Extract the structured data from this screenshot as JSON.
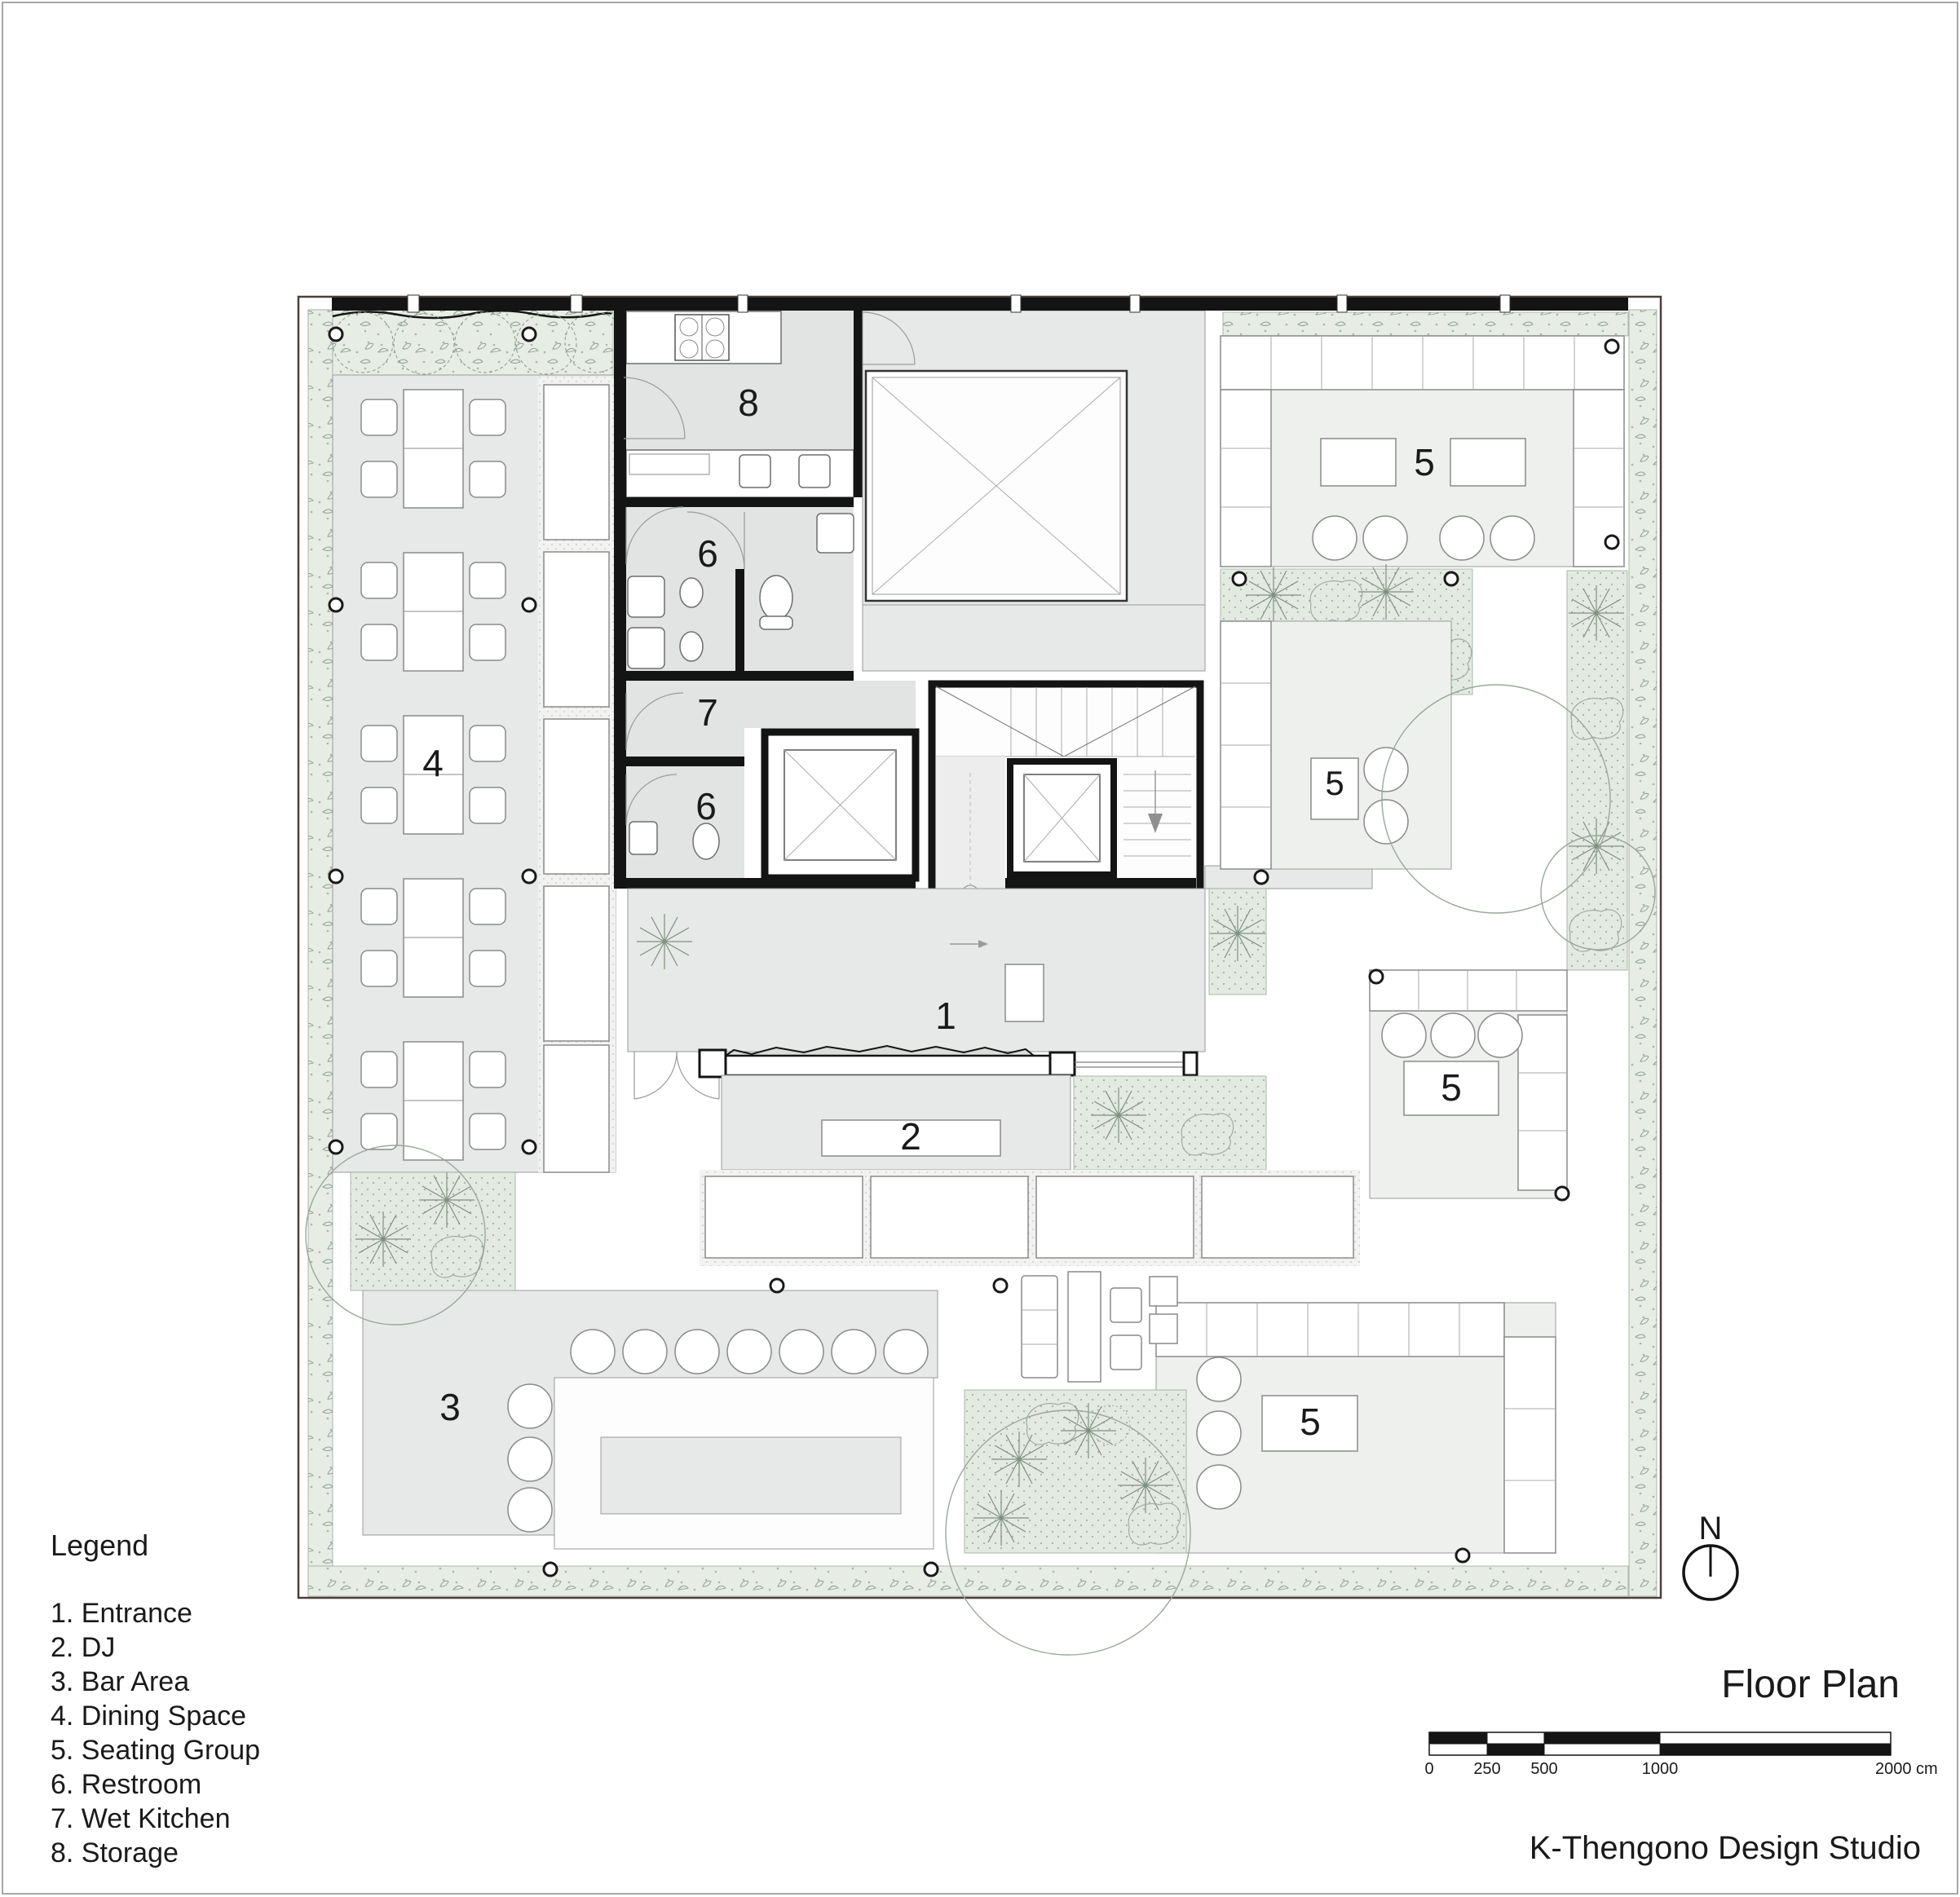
{
  "title_block": {
    "title": "Floor Plan",
    "studio": "K-Thengono Design Studio"
  },
  "north": {
    "label": "N"
  },
  "legend": {
    "title": "Legend",
    "items": [
      {
        "text": "1. Entrance"
      },
      {
        "text": "2. DJ"
      },
      {
        "text": "3. Bar Area"
      },
      {
        "text": "4. Dining Space"
      },
      {
        "text": "5. Seating Group"
      },
      {
        "text": "6. Restroom"
      },
      {
        "text": "7. Wet Kitchen"
      },
      {
        "text": "8. Storage"
      }
    ]
  },
  "plan": {
    "room_labels": {
      "entrance": "1",
      "dj": "2",
      "bar_area": "3",
      "dining_space": "4",
      "seating_group": "5",
      "restroom": "6",
      "wet_kitchen": "7",
      "storage": "8"
    }
  },
  "scale_bar": {
    "ticks": [
      "0",
      "250",
      "500",
      "1000"
    ],
    "end_label": "2000 cm"
  },
  "colors": {
    "hedge_green": "#e7ece5",
    "planter_green": "#e3eae2",
    "floor_gray": "#e7e8e8",
    "wall_black": "#141414"
  }
}
